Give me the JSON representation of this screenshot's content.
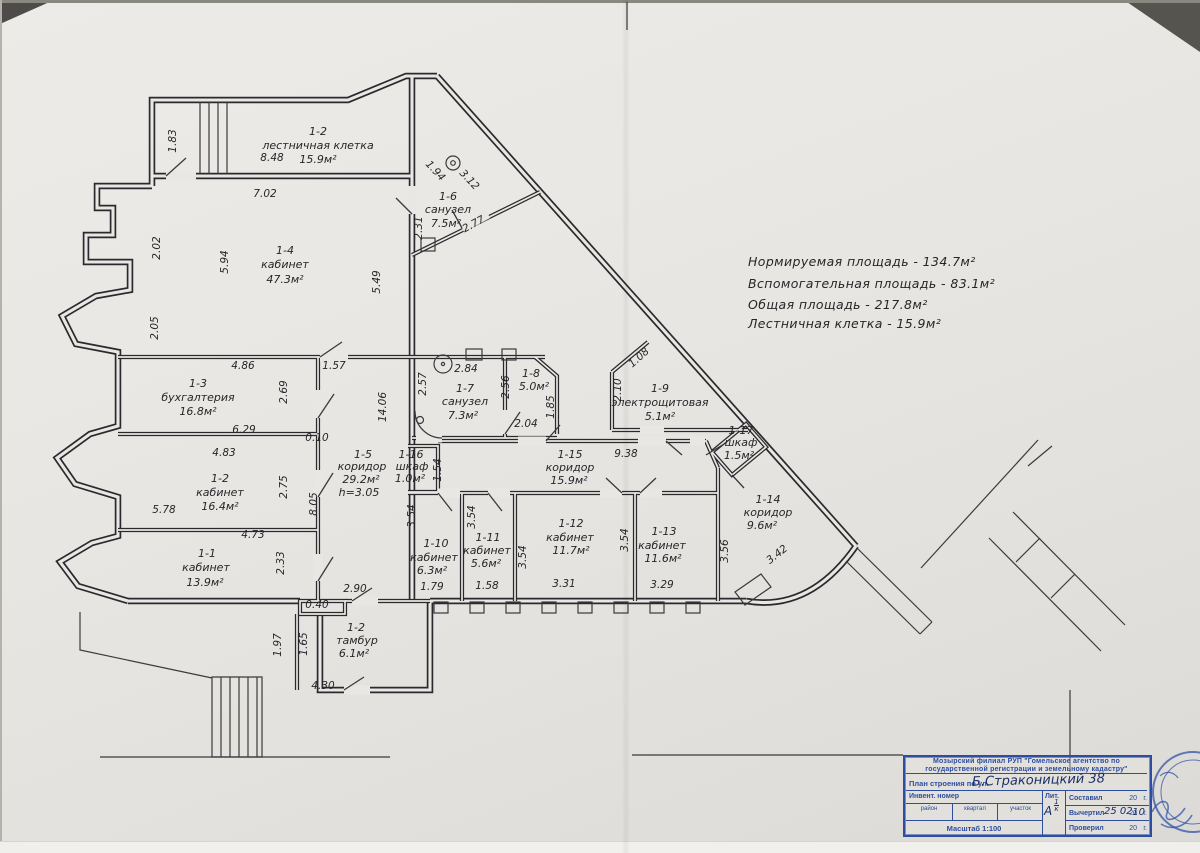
{
  "summary": {
    "line1": "Нормируемая  площадь - 134.7м²",
    "line2": "Вспомогательная  площадь - 83.1м²",
    "line3": "Общая  площадь - 217.8м²",
    "line4": "Лестничная  клетка - 15.9м²"
  },
  "rooms": {
    "stair": {
      "id": "1-2",
      "name": "лестничная клетка",
      "area": "15.9м²"
    },
    "r4": {
      "id": "1-4",
      "name": "кабинет",
      "area": "47.3м²"
    },
    "r6": {
      "id": "1-6",
      "name": "санузел",
      "area": "7.5м²"
    },
    "r3": {
      "id": "1-3",
      "name": "бухгалтерия",
      "area": "16.8м²"
    },
    "r7": {
      "id": "1-7",
      "name": "санузел",
      "area": "7.3м²"
    },
    "r8": {
      "id": "1-8",
      "area": "5.0м²"
    },
    "r9": {
      "id": "1-9",
      "name": "электрощитовая",
      "area": "5.1м²"
    },
    "r17": {
      "id": "1-17",
      "name": "шкаф",
      "area": "1.5м²"
    },
    "r5": {
      "id": "1-5",
      "name": "коридор",
      "area": "29.2м²",
      "height": "h=3.05"
    },
    "r16": {
      "id": "1-16",
      "name": "шкаф",
      "area": "1.0м²"
    },
    "r15": {
      "id": "1-15",
      "name": "коридор",
      "area": "15.9м²"
    },
    "r2": {
      "id": "1-2",
      "name": "кабинет",
      "area": "16.4м²"
    },
    "r1": {
      "id": "1-1",
      "name": "кабинет",
      "area": "13.9м²"
    },
    "r10": {
      "id": "1-10",
      "name": "кабинет",
      "area": "6.3м²"
    },
    "r11": {
      "id": "1-11",
      "name": "кабинет",
      "area": "5.6м²"
    },
    "r12": {
      "id": "1-12",
      "name": "кабинет",
      "area": "11.7м²"
    },
    "r13": {
      "id": "1-13",
      "name": "кабинет",
      "area": "11.6м²"
    },
    "r14": {
      "id": "1-14",
      "name": "коридор",
      "area": "9.6м²"
    },
    "tambur": {
      "id": "1-2",
      "name": "тамбур",
      "area": "6.1м²"
    }
  },
  "dims": {
    "stair_left": "1.83",
    "stair_top": "8.48",
    "top_wall": "7.02",
    "left_a": "2.02",
    "left_b": "2.05",
    "r4_left": "5.94",
    "r4_right": "5.49",
    "r6_diag_a": "1.94",
    "r6_diag_b": "3.12",
    "r6_bottom": "2.77",
    "r6_left": "2.31",
    "r3_top_a": "4.86",
    "r3_top_b": "1.57",
    "r3_right": "2.69",
    "r3_bottom": "6.29",
    "wall_t": "0.10",
    "corridor_len": "14.06",
    "r7_left": "2.57",
    "r7_top": "2.84",
    "r7_mid": "2.56",
    "r7_bottom": "2.04",
    "r8_right": "1.85",
    "r9_cut": "1.08",
    "r9_left": "2.10",
    "r15_len": "9.38",
    "r2_top": "4.83",
    "r16_right": "1.54",
    "r2_right": "2.75",
    "r5_right": "8.05",
    "r2_left": "5.78",
    "r1_top": "4.73",
    "r1_right": "2.33",
    "v354_a": "3.54",
    "v354_b": "3.54",
    "v354_c": "3.54",
    "v354_d": "3.54",
    "r13_right": "3.56",
    "r14_curve": "3.42",
    "r5_bottom": "2.90",
    "r10_w": "1.79",
    "r11_w": "1.58",
    "r12_w": "3.31",
    "r13_w": "3.29",
    "notch": "0.40",
    "porch_out": "1.97",
    "porch_in": "1.65",
    "tambur_bottom": "4.30"
  },
  "title_block": {
    "org_line1": "Мозырский филиал РУП \"Гомельское агентство по",
    "org_line2": "государственной регистрации и земельному кадастру\"",
    "plan_label": "План строения по ул.",
    "plan_value": "Б.Страконицкий  38",
    "invent_label": "Инвент. номер",
    "col_rayon": "район",
    "col_kvartal": "квартал",
    "col_uchastok": "участок",
    "lit_label": "Лит.",
    "lit_letter": "А",
    "lit_top": "1",
    "lit_bottom": "к",
    "sostavil": "Составил",
    "vychertil": "Вычертил",
    "proveril": "Проверил",
    "year_prefix": "20",
    "g_suffix": "г.",
    "vychertil_hand": "25 02",
    "vychertil_year_hand": "10",
    "masshtab": "Масштаб 1:100"
  },
  "colors": {
    "ink": "#26262a",
    "blue": "#2e4da0",
    "paper": "#e9e7e3"
  }
}
